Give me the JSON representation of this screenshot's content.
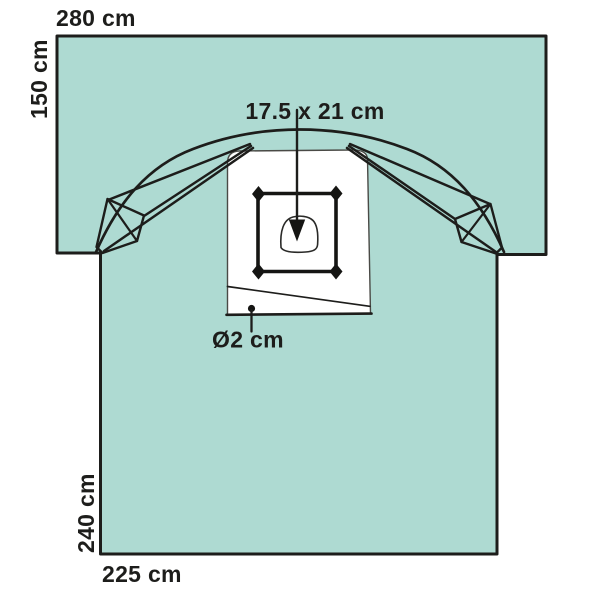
{
  "figure": {
    "dimensions": {
      "top_sheet_width": "280 cm",
      "top_sheet_height": "150 cm",
      "main_sheet_height": "240 cm",
      "main_sheet_width": "225 cm",
      "incise_area": "17.5 x 21 cm",
      "tube_hole_diameter": "Ø2 cm"
    },
    "colors": {
      "drape": "#aedad2",
      "outline": "#1d1d1b",
      "panel": "#ffffff"
    }
  }
}
